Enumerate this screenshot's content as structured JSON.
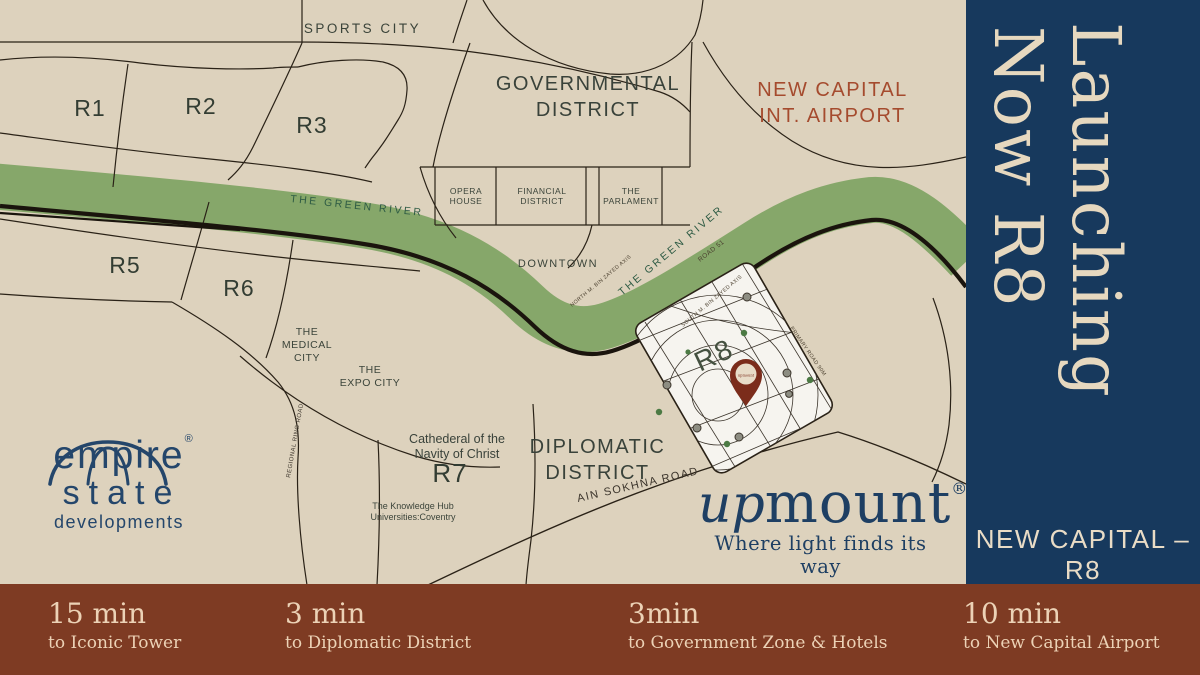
{
  "colors": {
    "background_cream": "#ddd2bd",
    "sidebar_navy": "#17395d",
    "footer_brown": "#7e3b23",
    "river_green": "#86a76a",
    "river_label_green": "#2e5b44",
    "airport_red": "#a54b2e",
    "map_line": "#2a2217",
    "r8_zone_white": "#f6f4ef",
    "pin_maroon": "#7b2c1b",
    "logo_navy": "#24466b",
    "cream_text": "#e6d8bf"
  },
  "map": {
    "region_labels": {
      "sports_city": "SPORTS CITY",
      "r1": "R1",
      "r2": "R2",
      "r3": "R3",
      "r5": "R5",
      "r6": "R6",
      "r7": "R7",
      "r8": "R8",
      "governmental_district": "GOVERNMENTAL\nDISTRICT",
      "new_capital_airport": "NEW CAPITAL\nINT. AIRPORT",
      "downtown": "DOWNTOWN",
      "medical_city": "THE\nMEDICAL\nCITY",
      "expo_city": "THE\nEXPO CITY",
      "cathedral": "Cathederal of the\nNavity of Christ",
      "knowledge_hub": "The Knowledge Hub\nUniversities:Coventry",
      "diplomatic_district": "DIPLOMATIC\nDISTRICT"
    },
    "poi_boxes": {
      "opera": "OPERA\nHOUSE",
      "financial": "FINANCIAL\nDISTRICT",
      "parliament": "THE\nPARLAMENT"
    },
    "road_labels": {
      "green_river": "THE GREEN RIVER",
      "green_river_2": "THE GREEN RIVER",
      "ain_sokhna": "AIN SOKHNA ROAD",
      "regional_ring": "REGIONAL RING ROAD",
      "road_51": "ROAD 51",
      "north_axis": "NORTH M. BIN ZAYED AXIS",
      "south_axis": "SOUTH M. BIN ZAYED AXIS",
      "primary_road": "PRIMARY ROAD 90M"
    },
    "pin_label": "upmount"
  },
  "sidebar": {
    "launching": "Launching",
    "now_r8": "Now R8",
    "location_label": "NEW CAPITAL – R8"
  },
  "footer": {
    "items": [
      {
        "time": "15 min",
        "dest": "to Iconic Tower"
      },
      {
        "time": "3 min",
        "dest": "to Diplomatic District"
      },
      {
        "time": "3min",
        "dest": "to Government Zone & Hotels"
      },
      {
        "time": "10 min",
        "dest": "to New Capital Airport"
      }
    ]
  },
  "logos": {
    "empire": {
      "name_top": "empire",
      "name_bottom": "state",
      "subtitle": "developments",
      "reg": "®"
    },
    "upmount": {
      "up": "up",
      "mount": "mount",
      "reg": "®",
      "tagline": "Where light finds its way"
    }
  }
}
